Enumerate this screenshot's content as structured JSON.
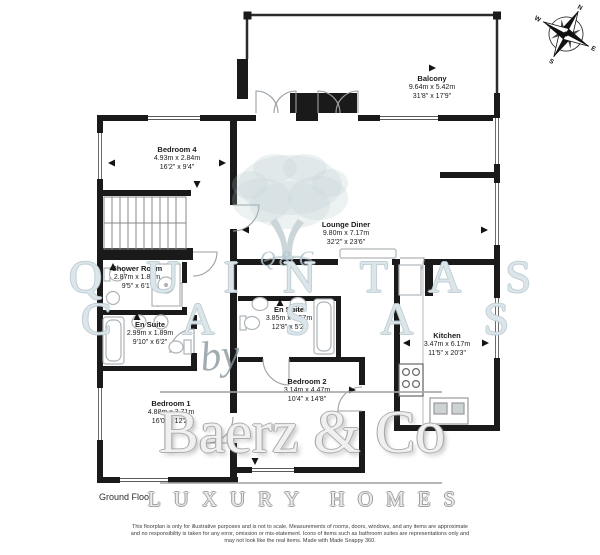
{
  "floor_label": "Ground Floor",
  "rooms": [
    {
      "name": "Balcony",
      "metric": "9.64m x 5.42m",
      "imperial": "31'8\" x 17'9\""
    },
    {
      "name": "Bedroom 4",
      "metric": "4.93m x 2.84m",
      "imperial": "16'2\" x 9'4\""
    },
    {
      "name": "Lounge Diner",
      "metric": "9.80m x 7.17m",
      "imperial": "32'2\" x 23'6\""
    },
    {
      "name": "Shower Room",
      "metric": "2.87m x 1.86m",
      "imperial": "9'5\" x 6'1\""
    },
    {
      "name": "En Suite",
      "metric": "2.99m x 1.89m",
      "imperial": "9'10\" x 6'2\""
    },
    {
      "name": "En Suite",
      "metric": "3.85m x 1.57m",
      "imperial": "12'8\" x 5'2\""
    },
    {
      "name": "Kitchen",
      "metric": "3.47m x 6.17m",
      "imperial": "11'5\" x 20'3\""
    },
    {
      "name": "Bedroom 2",
      "metric": "3.14m x 4.47m",
      "imperial": "10'4\" x 14'8\""
    },
    {
      "name": "Bedroom 1",
      "metric": "4.88m x 3.71m",
      "imperial": "16'0\" x 12'2\""
    }
  ],
  "compass": {
    "n": "N",
    "e": "E",
    "s": "S",
    "w": "W"
  },
  "watermark": {
    "monogram": "Q&C",
    "name_line1": "QUINTAS",
    "name_line2": "CASAS",
    "by": "by",
    "brand": "Baerz & Co",
    "tagline": "LUXURY HOMES"
  },
  "disclaimer": {
    "line1": "This floorplan is only for illustrative purposes and is not to scale. Measurements of rooms, doors, windows, and any items are approximate",
    "line2": "and no responsibility is taken for any error, omission or mis-statement. Icons of items such as bathroom suites are representations only and",
    "line3": "may not look like the real items. Made with Made Snappy 360."
  },
  "colors": {
    "wall": "#1a1a1a",
    "door_arc": "#9aa0a4",
    "fixture": "#aeb4b7",
    "watermark_blue": "#b7c6cb",
    "watermark_gray": "#ababab"
  }
}
